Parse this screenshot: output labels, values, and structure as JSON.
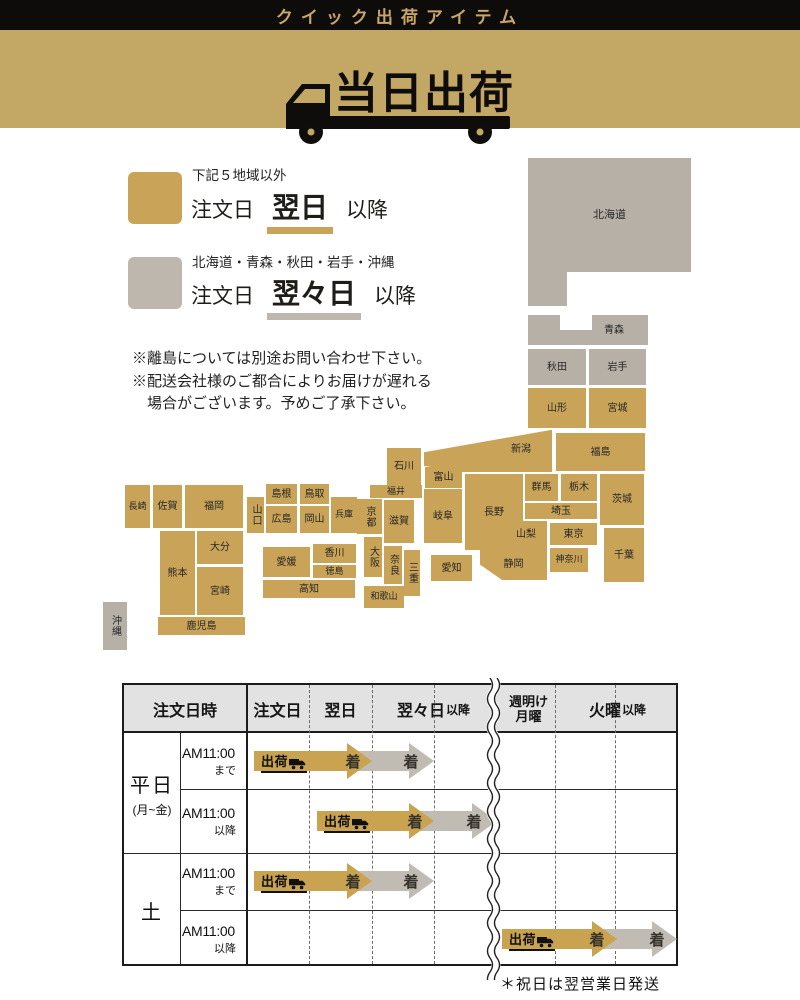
{
  "header": {
    "top_title": "クイック出荷アイテム",
    "banner_title": "当日出荷"
  },
  "legend": {
    "next_day": {
      "condition": "下記５地域以外",
      "prefix": "注文日",
      "highlight": "翌日",
      "suffix": "以降"
    },
    "two_days": {
      "condition": "北海道・青森・秋田・岩手・沖縄",
      "prefix": "注文日",
      "highlight": "翌々日",
      "suffix": "以降"
    }
  },
  "notes": {
    "line1": "※離島については別途お問い合わせ下さい。",
    "line2": "※配送会社様のご都合によりお届けが遅れる",
    "line3": "　場合がございます。予めご了承下さい。"
  },
  "map": {
    "prefectures": {
      "hokkaido": "北海道",
      "aomori": "青森",
      "akita": "秋田",
      "iwate": "岩手",
      "yamagata": "山形",
      "miyagi": "宮城",
      "fukushima": "福島",
      "niigata": "新潟",
      "toyama": "富山",
      "ishikawa": "石川",
      "fukui": "福井",
      "nagano": "長野",
      "gunma": "群馬",
      "tochigi": "栃木",
      "ibaraki": "茨城",
      "saitama": "埼玉",
      "yamanashi": "山梨",
      "tokyo": "東京",
      "chiba": "千葉",
      "kanagawa": "神奈川",
      "shizuoka": "静岡",
      "gifu": "岐阜",
      "aichi": "愛知",
      "mie": "三重",
      "shiga": "滋賀",
      "kyoto": "京都",
      "osaka": "大阪",
      "nara": "奈良",
      "wakayama": "和歌山",
      "hyogo": "兵庫",
      "tottori": "鳥取",
      "shimane": "島根",
      "okayama": "岡山",
      "hiroshima": "広島",
      "yamaguchi": "山口",
      "kagawa": "香川",
      "tokushima": "徳島",
      "ehime": "愛媛",
      "kochi": "高知",
      "fukuoka": "福岡",
      "saga": "佐賀",
      "nagasaki": "長崎",
      "oita": "大分",
      "kumamoto": "熊本",
      "miyazaki": "宮崎",
      "kagoshima": "鹿児島",
      "okinawa": "沖縄"
    }
  },
  "table": {
    "columns": {
      "datetime": "注文日時",
      "order": "注文日",
      "next": "翌日",
      "after2": "翌々日",
      "after2_small": "以降",
      "week_mon1": "週明け",
      "week_mon2": "月曜",
      "tue": "火曜",
      "tue_small": "以降"
    },
    "row_groups": [
      {
        "label": "平日",
        "sub": "(月~金)"
      },
      {
        "label": "土",
        "sub": ""
      }
    ],
    "rows": [
      {
        "time": "AM11:00",
        "qualifier": "まで"
      },
      {
        "time": "AM11:00",
        "qualifier": "以降"
      },
      {
        "time": "AM11:00",
        "qualifier": "まで"
      },
      {
        "time": "AM11:00",
        "qualifier": "以降"
      }
    ],
    "arrow_labels": {
      "ship": "出荷",
      "arrive": "着"
    },
    "footnote": "＊祝日は翌営業日発送"
  },
  "colors": {
    "gold": "#c9a458",
    "map-gray": "#b7b0a7",
    "banner-gold": "#c3a765",
    "arrow-gold": "#c9a34f",
    "arrow-gray": "#c0bcb4",
    "header-bg": "#e2e2e2",
    "title-gold": "#c9a76a",
    "legend-gray": "#bdb7ae"
  }
}
